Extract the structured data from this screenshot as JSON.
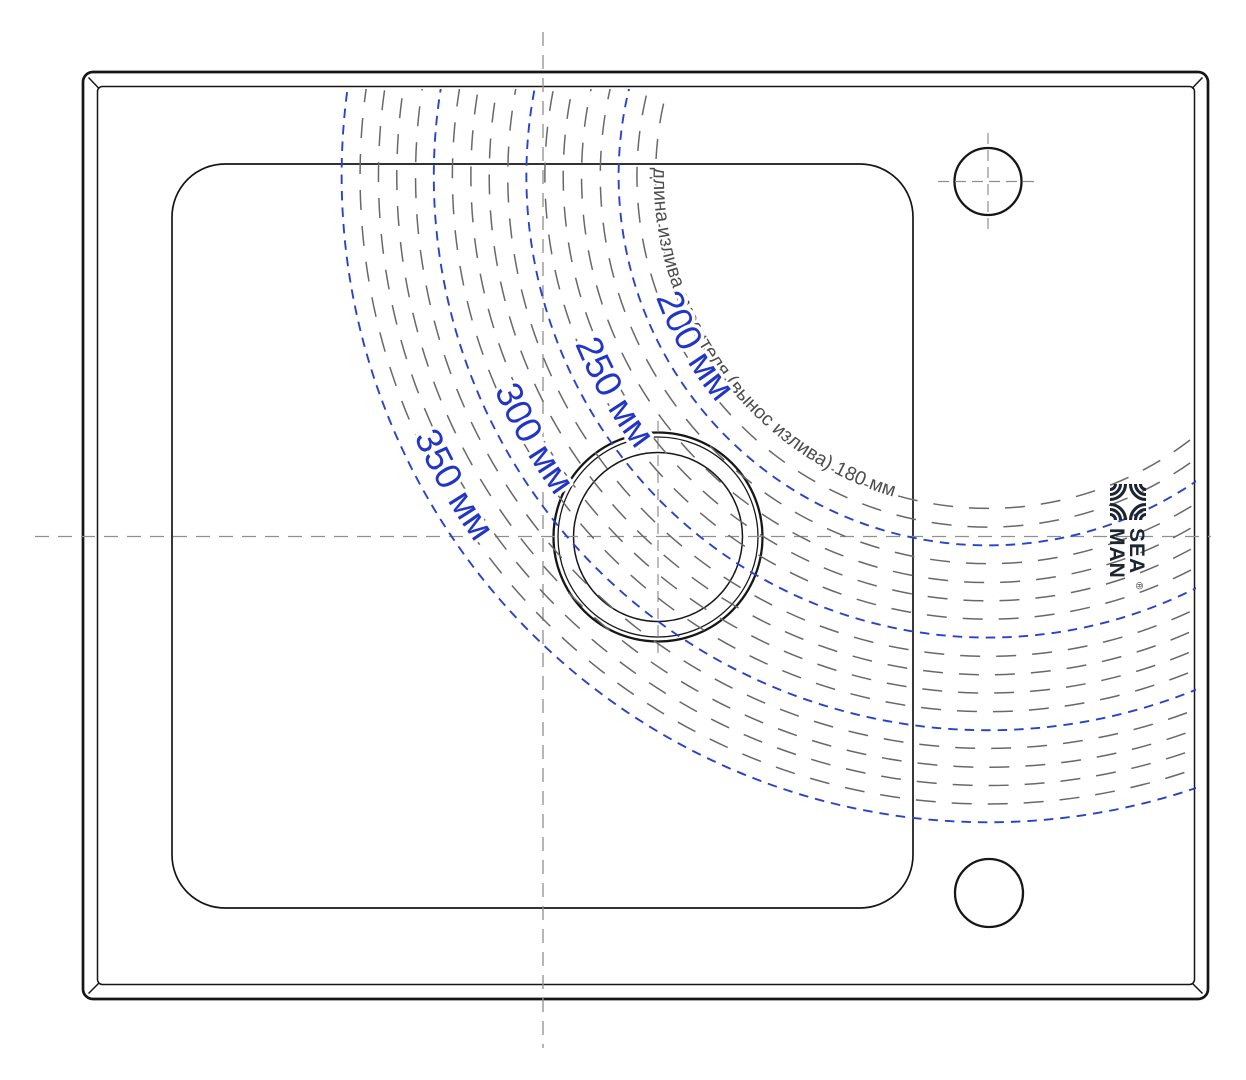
{
  "diagram": {
    "type": "sink-top-view-spout-reach",
    "note": {
      "text": "длина излива смесителя (вынос излива) 180 мм",
      "radius_mm": 180
    },
    "reach_labels": [
      {
        "text": "350 мм",
        "radius_mm": 350
      },
      {
        "text": "300 мм",
        "radius_mm": 300
      },
      {
        "text": "250 мм",
        "radius_mm": 250
      },
      {
        "text": "200 мм",
        "radius_mm": 200
      }
    ],
    "blue_radii_mm": [
      200,
      250,
      300,
      350
    ],
    "minor_radii_mm": [
      180,
      190,
      210,
      220,
      230,
      240,
      260,
      270,
      280,
      290,
      310,
      320,
      330,
      340
    ]
  },
  "logo": {
    "line1": "SEA",
    "line2": "MAN",
    "reg": "®"
  },
  "colors": {
    "reach_blue": "#2843c9",
    "minor_gray": "#686868",
    "centerline_gray": "#8f8f8f",
    "outline_black": "#161616",
    "logo_navy": "#1d2531"
  }
}
